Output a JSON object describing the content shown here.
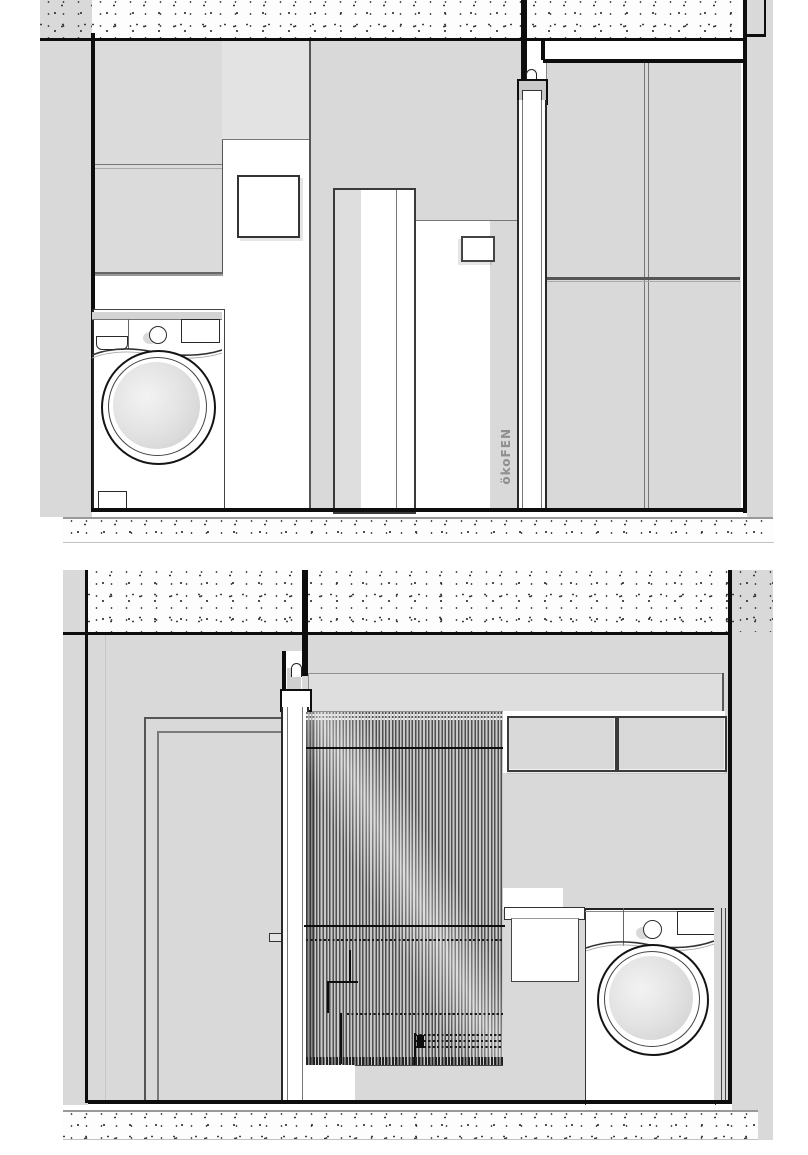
{
  "labels": {
    "brand_logo": "ökoFEN"
  },
  "colors": {
    "paper": "#ffffff",
    "wall": "#d9d9d9",
    "wall_light": "#e3e3e3",
    "cabinet": "#dbdbdb",
    "band": "#dedede",
    "line_black": "#0d0d0d",
    "line_dark": "#333333",
    "line_mid": "#666666",
    "curtain_dark": "#4f4f4f",
    "curtain_light": "#c9c9c9"
  }
}
